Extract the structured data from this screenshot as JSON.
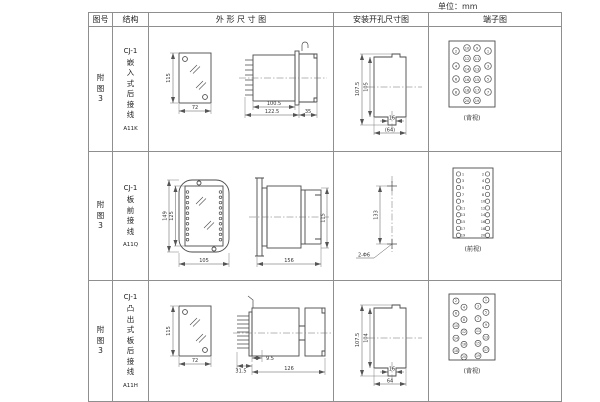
{
  "units_label": "单位：mm",
  "table": {
    "headers": {
      "fig_no": "图号",
      "structure": "结构",
      "outline": "外 形 尺 寸 图",
      "mounting": "安装开孔尺寸图",
      "terminal": "端子图"
    },
    "rows": [
      {
        "fig_no": "附图3",
        "series": "CJ-1",
        "mount_type": "嵌入式后接线",
        "model": "A11K",
        "outline": {
          "front_h": "115",
          "front_w": "72",
          "body_len": "100.5",
          "total_len": "122.5",
          "flange_len": "35"
        },
        "mounting": {
          "outer_h": "107.5",
          "inner_h": "105",
          "slot_w": "16",
          "cutout_w": "(64)"
        },
        "terminal": {
          "view": "(背视)",
          "groups": [
            [
              2,
              4,
              6,
              8
            ],
            [
              10,
              12,
              14,
              16,
              18,
              20
            ],
            [
              9,
              11,
              13,
              15,
              17,
              19
            ],
            [
              1,
              3,
              5,
              7
            ]
          ]
        }
      },
      {
        "fig_no": "附图3",
        "series": "CJ-1",
        "mount_type": "板前接线",
        "model": "A11Q",
        "outline": {
          "front_h": "149",
          "inner_h": "125",
          "front_w": "105",
          "body_len": "156",
          "side_h": "115"
        },
        "mounting": {
          "hole_dist": "133",
          "hole_label": "2-Φ6"
        },
        "terminal": {
          "view": "(前视)",
          "groups": [
            [
              1,
              3,
              5,
              7,
              9,
              11,
              13,
              15,
              17,
              19
            ],
            [
              2,
              4,
              6,
              8,
              10,
              12,
              14,
              16,
              18,
              20
            ]
          ]
        }
      },
      {
        "fig_no": "附图3",
        "series": "CJ-1",
        "mount_type": "凸出式板后接线",
        "model": "A11H",
        "outline": {
          "front_h": "115",
          "front_w": "72",
          "pin_len": "31.5",
          "gap": "9.5",
          "body_len": "126"
        },
        "mounting": {
          "outer_h": "107.5",
          "inner_h": "104",
          "slot_w": "16",
          "cutout_w": "64"
        },
        "terminal": {
          "view": "(背视)",
          "groups": [
            [
              2,
              4,
              6,
              8,
              10,
              12,
              14,
              16,
              18,
              20
            ],
            [
              1,
              3,
              5,
              7,
              9,
              11,
              13,
              15,
              17,
              19
            ]
          ]
        }
      }
    ]
  }
}
